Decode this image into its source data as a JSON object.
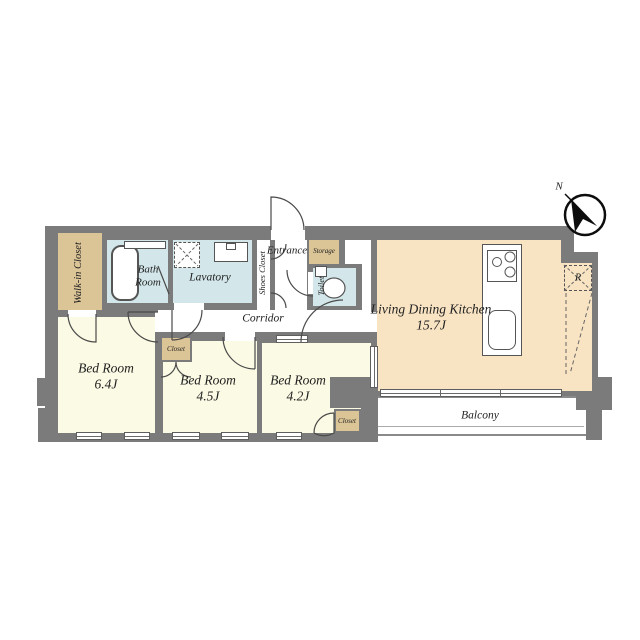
{
  "plan": {
    "title": "apartment-floor-plan",
    "compass": {
      "north_label": "N"
    },
    "rooms": {
      "walk_in_closet": {
        "label": "Walk-in Closet"
      },
      "bath_room": {
        "label": "Bath Room"
      },
      "lavatory": {
        "label": "Lavatory"
      },
      "shoes_closet": {
        "label": "Shoes Closet"
      },
      "entrance": {
        "label": "Entrance"
      },
      "storage": {
        "label": "Storage"
      },
      "toilet": {
        "label": "Toilet"
      },
      "corridor": {
        "label": "Corridor"
      },
      "living_dining_kitchen": {
        "label": "Living Dining Kitchen",
        "size": "15.7J"
      },
      "bedroom_1": {
        "label": "Bed Room",
        "size": "6.4J"
      },
      "bedroom_2": {
        "label": "Bed Room",
        "size": "4.5J"
      },
      "bedroom_3": {
        "label": "Bed Room",
        "size": "4.2J"
      },
      "bedroom_2_closet": {
        "label": "Closet"
      },
      "bedroom_3_closet": {
        "label": "Closet"
      },
      "balcony": {
        "label": "Balcony"
      },
      "refrigerator": {
        "label": "R"
      }
    },
    "colors": {
      "wall": "#7b7b7b",
      "bedroom_fill": "#fbfae4",
      "ldk_fill": "#f8e3c2",
      "wet_area_fill": "#d3e7ea",
      "closet_fill": "#dbc496",
      "corridor_fill": "#ffffff"
    }
  }
}
